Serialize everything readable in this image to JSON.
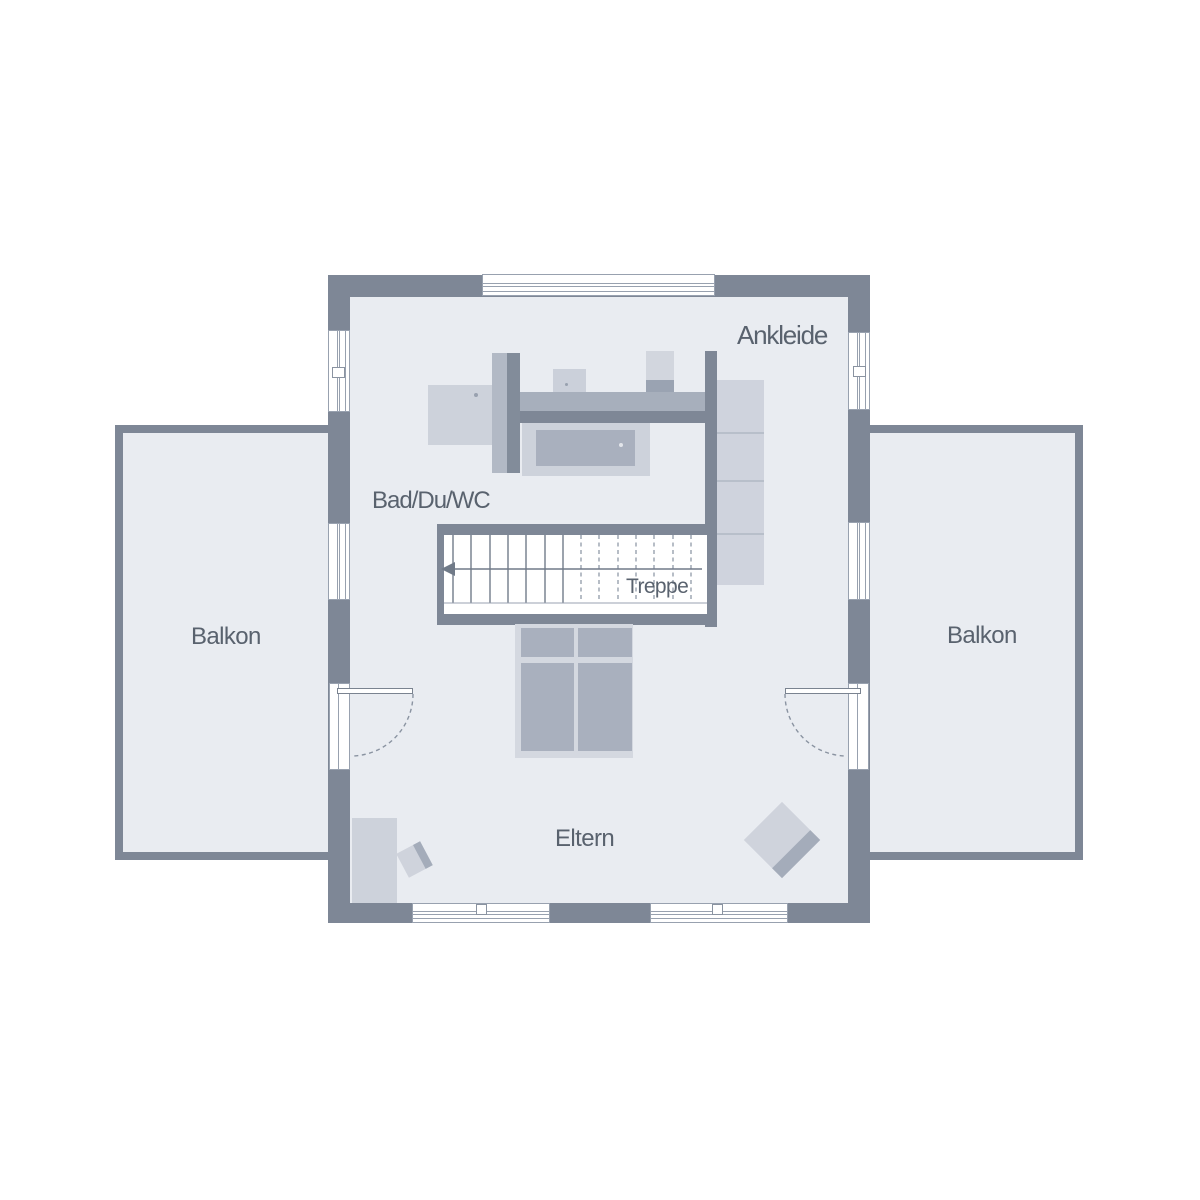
{
  "plan": {
    "type": "floor-plan-upper-storey",
    "rooms": {
      "ankleide": {
        "label": "Ankleide"
      },
      "bad": {
        "label": "Bad/Du/WC"
      },
      "treppe": {
        "label": "Treppe"
      },
      "eltern": {
        "label": "Eltern"
      },
      "balkon_left": {
        "label": "Balkon"
      },
      "balkon_right": {
        "label": "Balkon"
      }
    },
    "colors": {
      "wall": "#7E8796",
      "room_fill": "#E9ECF1",
      "balcony_fill": "#E9ECF1",
      "furniture_light": "#CDD2DB",
      "furniture_medium": "#A9B0BE",
      "bed_frame": "#D4D8E0",
      "wardrobe": "#CFD3DD",
      "label_text": "#59626E",
      "frame_line": "#98A1AF",
      "stair_line": "#727C8A",
      "background": "#FFFFFF"
    }
  }
}
